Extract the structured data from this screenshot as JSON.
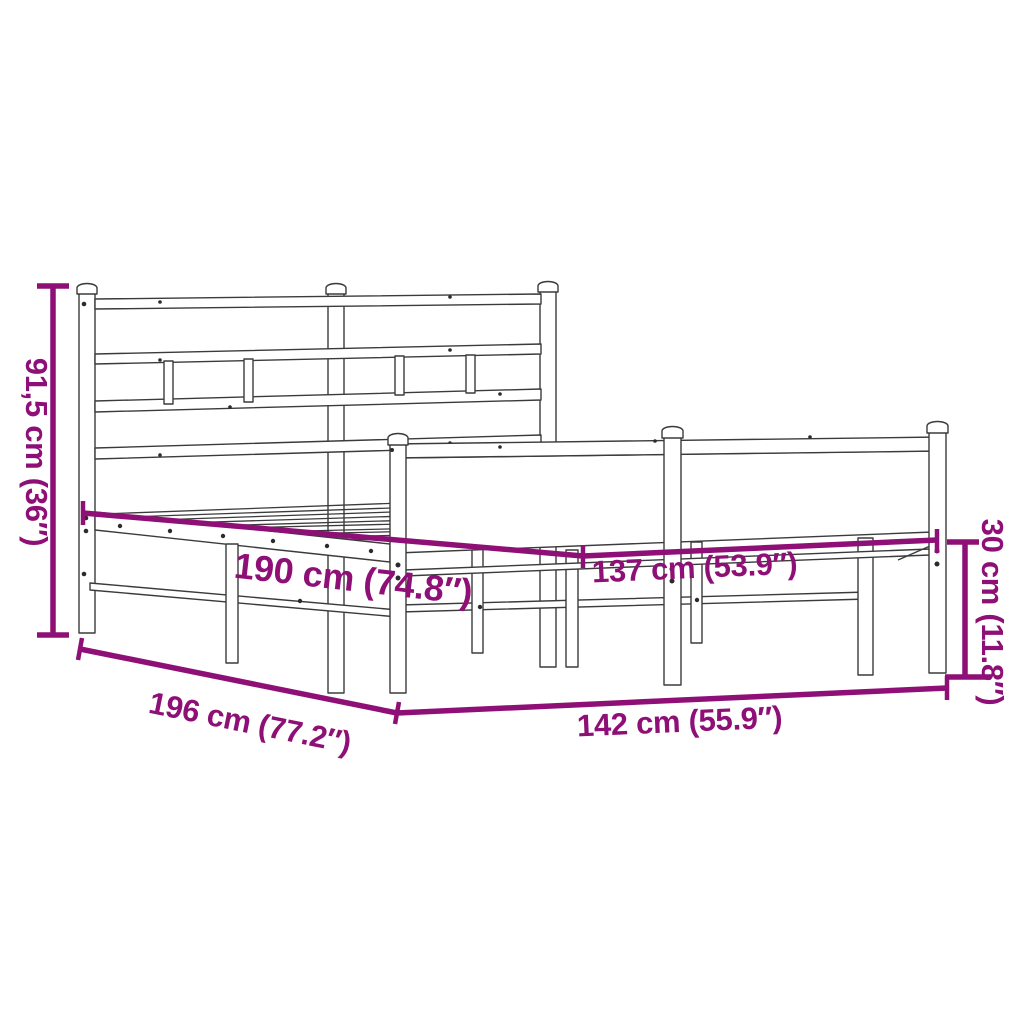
{
  "image_type": "product dimension diagram",
  "subject": "metal bed frame with headboard and footboard, slatted base",
  "colors": {
    "dimension_annotation": "#8E1077",
    "line_art": "#3b3b3b",
    "background": "#ffffff"
  },
  "dimensions": {
    "headboard_height": {
      "label": "91,5 cm (36″)",
      "orientation": "vertical-left"
    },
    "inner_length": {
      "label": "190 cm (74.8″)",
      "orientation": "diagonal-middle"
    },
    "inner_width": {
      "label": "137 cm (53.9″)",
      "orientation": "diagonal-middle-right"
    },
    "outer_length": {
      "label": "196 cm (77.2″)",
      "orientation": "diagonal-bottom-left"
    },
    "outer_width": {
      "label": "142 cm (55.9″)",
      "orientation": "bottom"
    },
    "footboard_height": {
      "label": "30 cm (11.8″)",
      "orientation": "vertical-right"
    }
  }
}
